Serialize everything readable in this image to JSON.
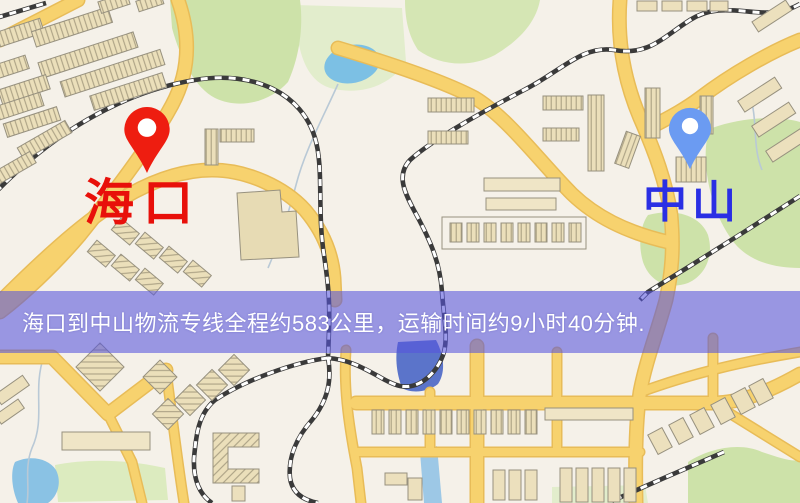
{
  "window": {
    "width": 800,
    "height": 503
  },
  "map": {
    "kind": "road-map-screenshot",
    "markers": [
      {
        "id": "origin",
        "label": "海口",
        "label_color": "#e8100a",
        "pin_color": "#ee1d10",
        "pin_hole_color": "#ffffff",
        "x": 147,
        "y": 172
      },
      {
        "id": "destination",
        "label": "中山",
        "label_color": "#2a2fe4",
        "pin_color": "#6b9bf2",
        "pin_hole_color": "#ffffff",
        "x": 690,
        "y": 171
      }
    ],
    "banner": {
      "text": "海口到中山物流专线全程约583公里，运输时间约9小时40分钟.",
      "background": "#5654dc",
      "background_opacity": 0.58,
      "text_color": "#ffffff"
    },
    "route": {
      "from": "海口",
      "to": "中山",
      "distance_km": 583,
      "duration_text": "9小时40分钟"
    },
    "palette": {
      "map_background": "#f5f1e9",
      "road_fill": "#f7d26e",
      "road_casing": "#e8bc58",
      "park_green": "#cde2a9",
      "park_green_light": "#e2edcc",
      "pond_blue": "#7cc0e4",
      "river_blue": "#5b74ca",
      "building_fill": "#ece0bd",
      "building_stroke": "#97917f",
      "railway_dark": "#3a3a3a",
      "railway_light": "#ffffff",
      "stream_gray": "#b9c9d6"
    }
  }
}
